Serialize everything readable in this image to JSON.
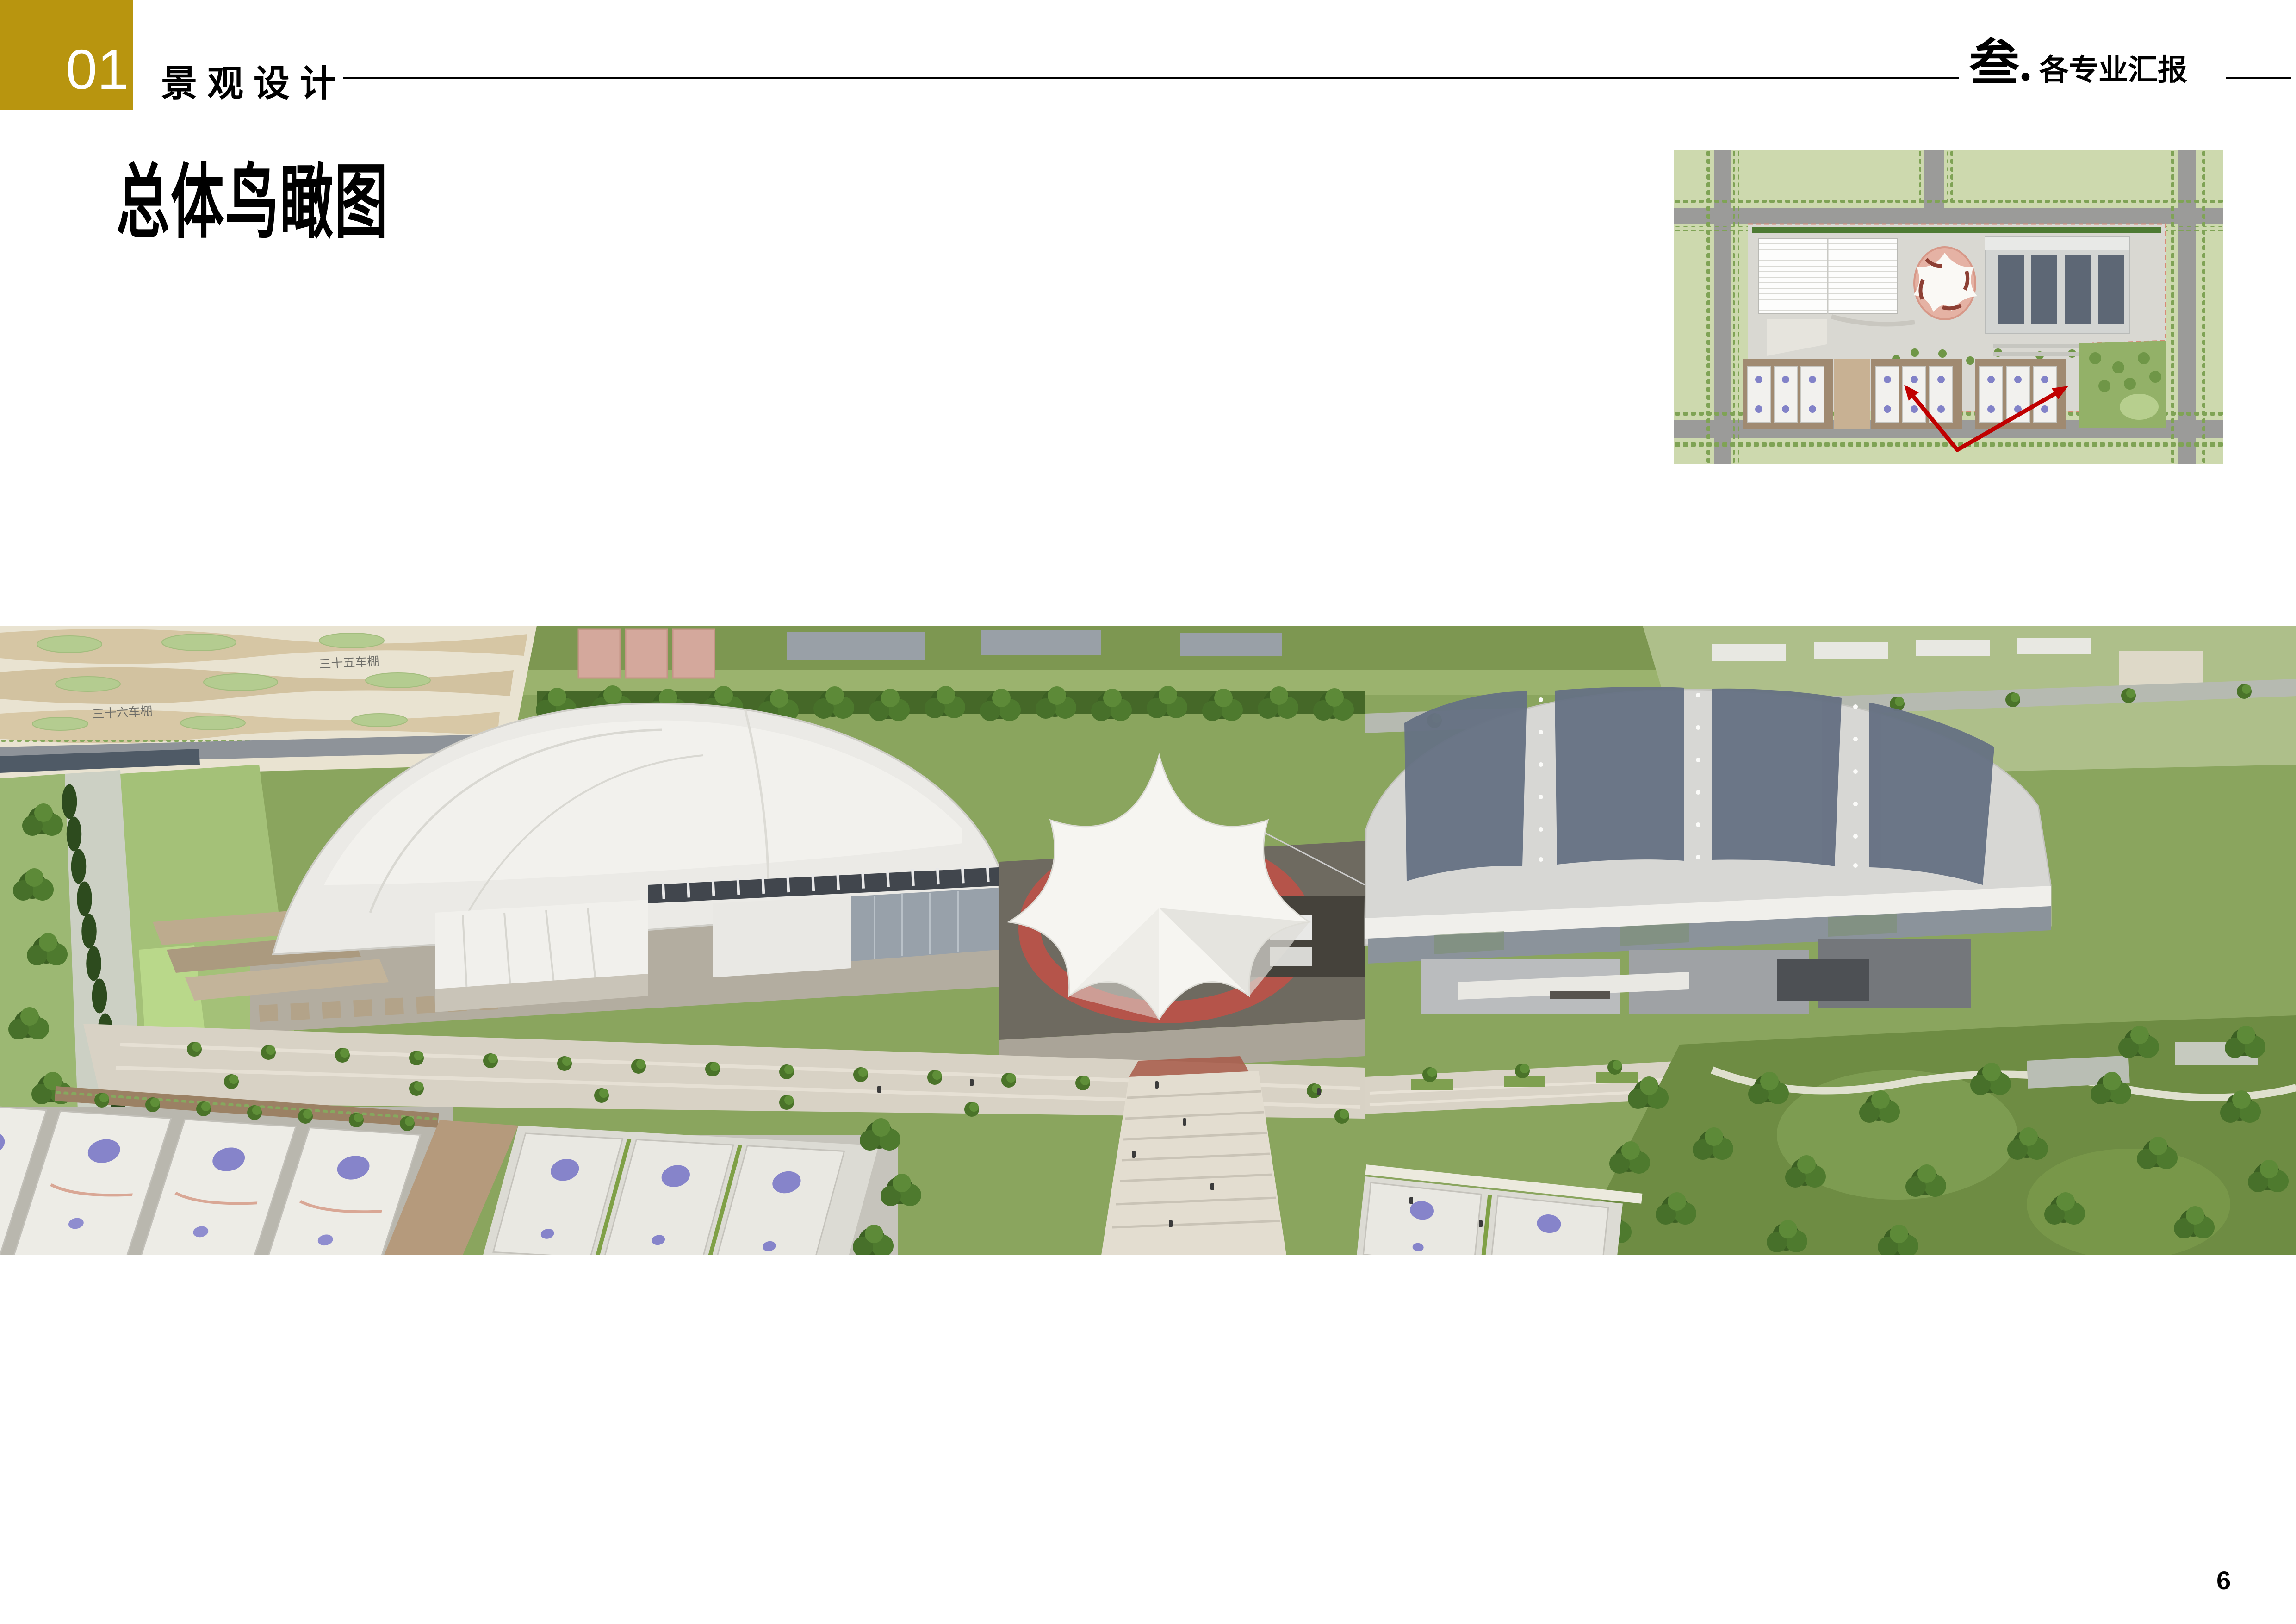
{
  "header": {
    "section_number": "01",
    "section_title": "景观设计",
    "chapter_index": "叁.",
    "chapter_label": "各专业汇报"
  },
  "page": {
    "title": "总体鸟瞰图",
    "page_number": "6"
  },
  "render": {
    "description": "overall aerial bird's-eye rendering of sports complex",
    "context_labels": [
      "三十五车棚",
      "三十六车棚"
    ]
  },
  "inset_plan": {
    "description": "site plan key map with red arrows marking viewpoint of courts"
  },
  "colors": {
    "accent_gold": "#B8950F",
    "arrow_red": "#C00000",
    "court_mark_purple": "#8684CA",
    "stadium_pink": "#E5B2A4",
    "roof_gray": "#D7D7D4",
    "panel_slate": "#667183",
    "park_green": "#6E8C43"
  }
}
